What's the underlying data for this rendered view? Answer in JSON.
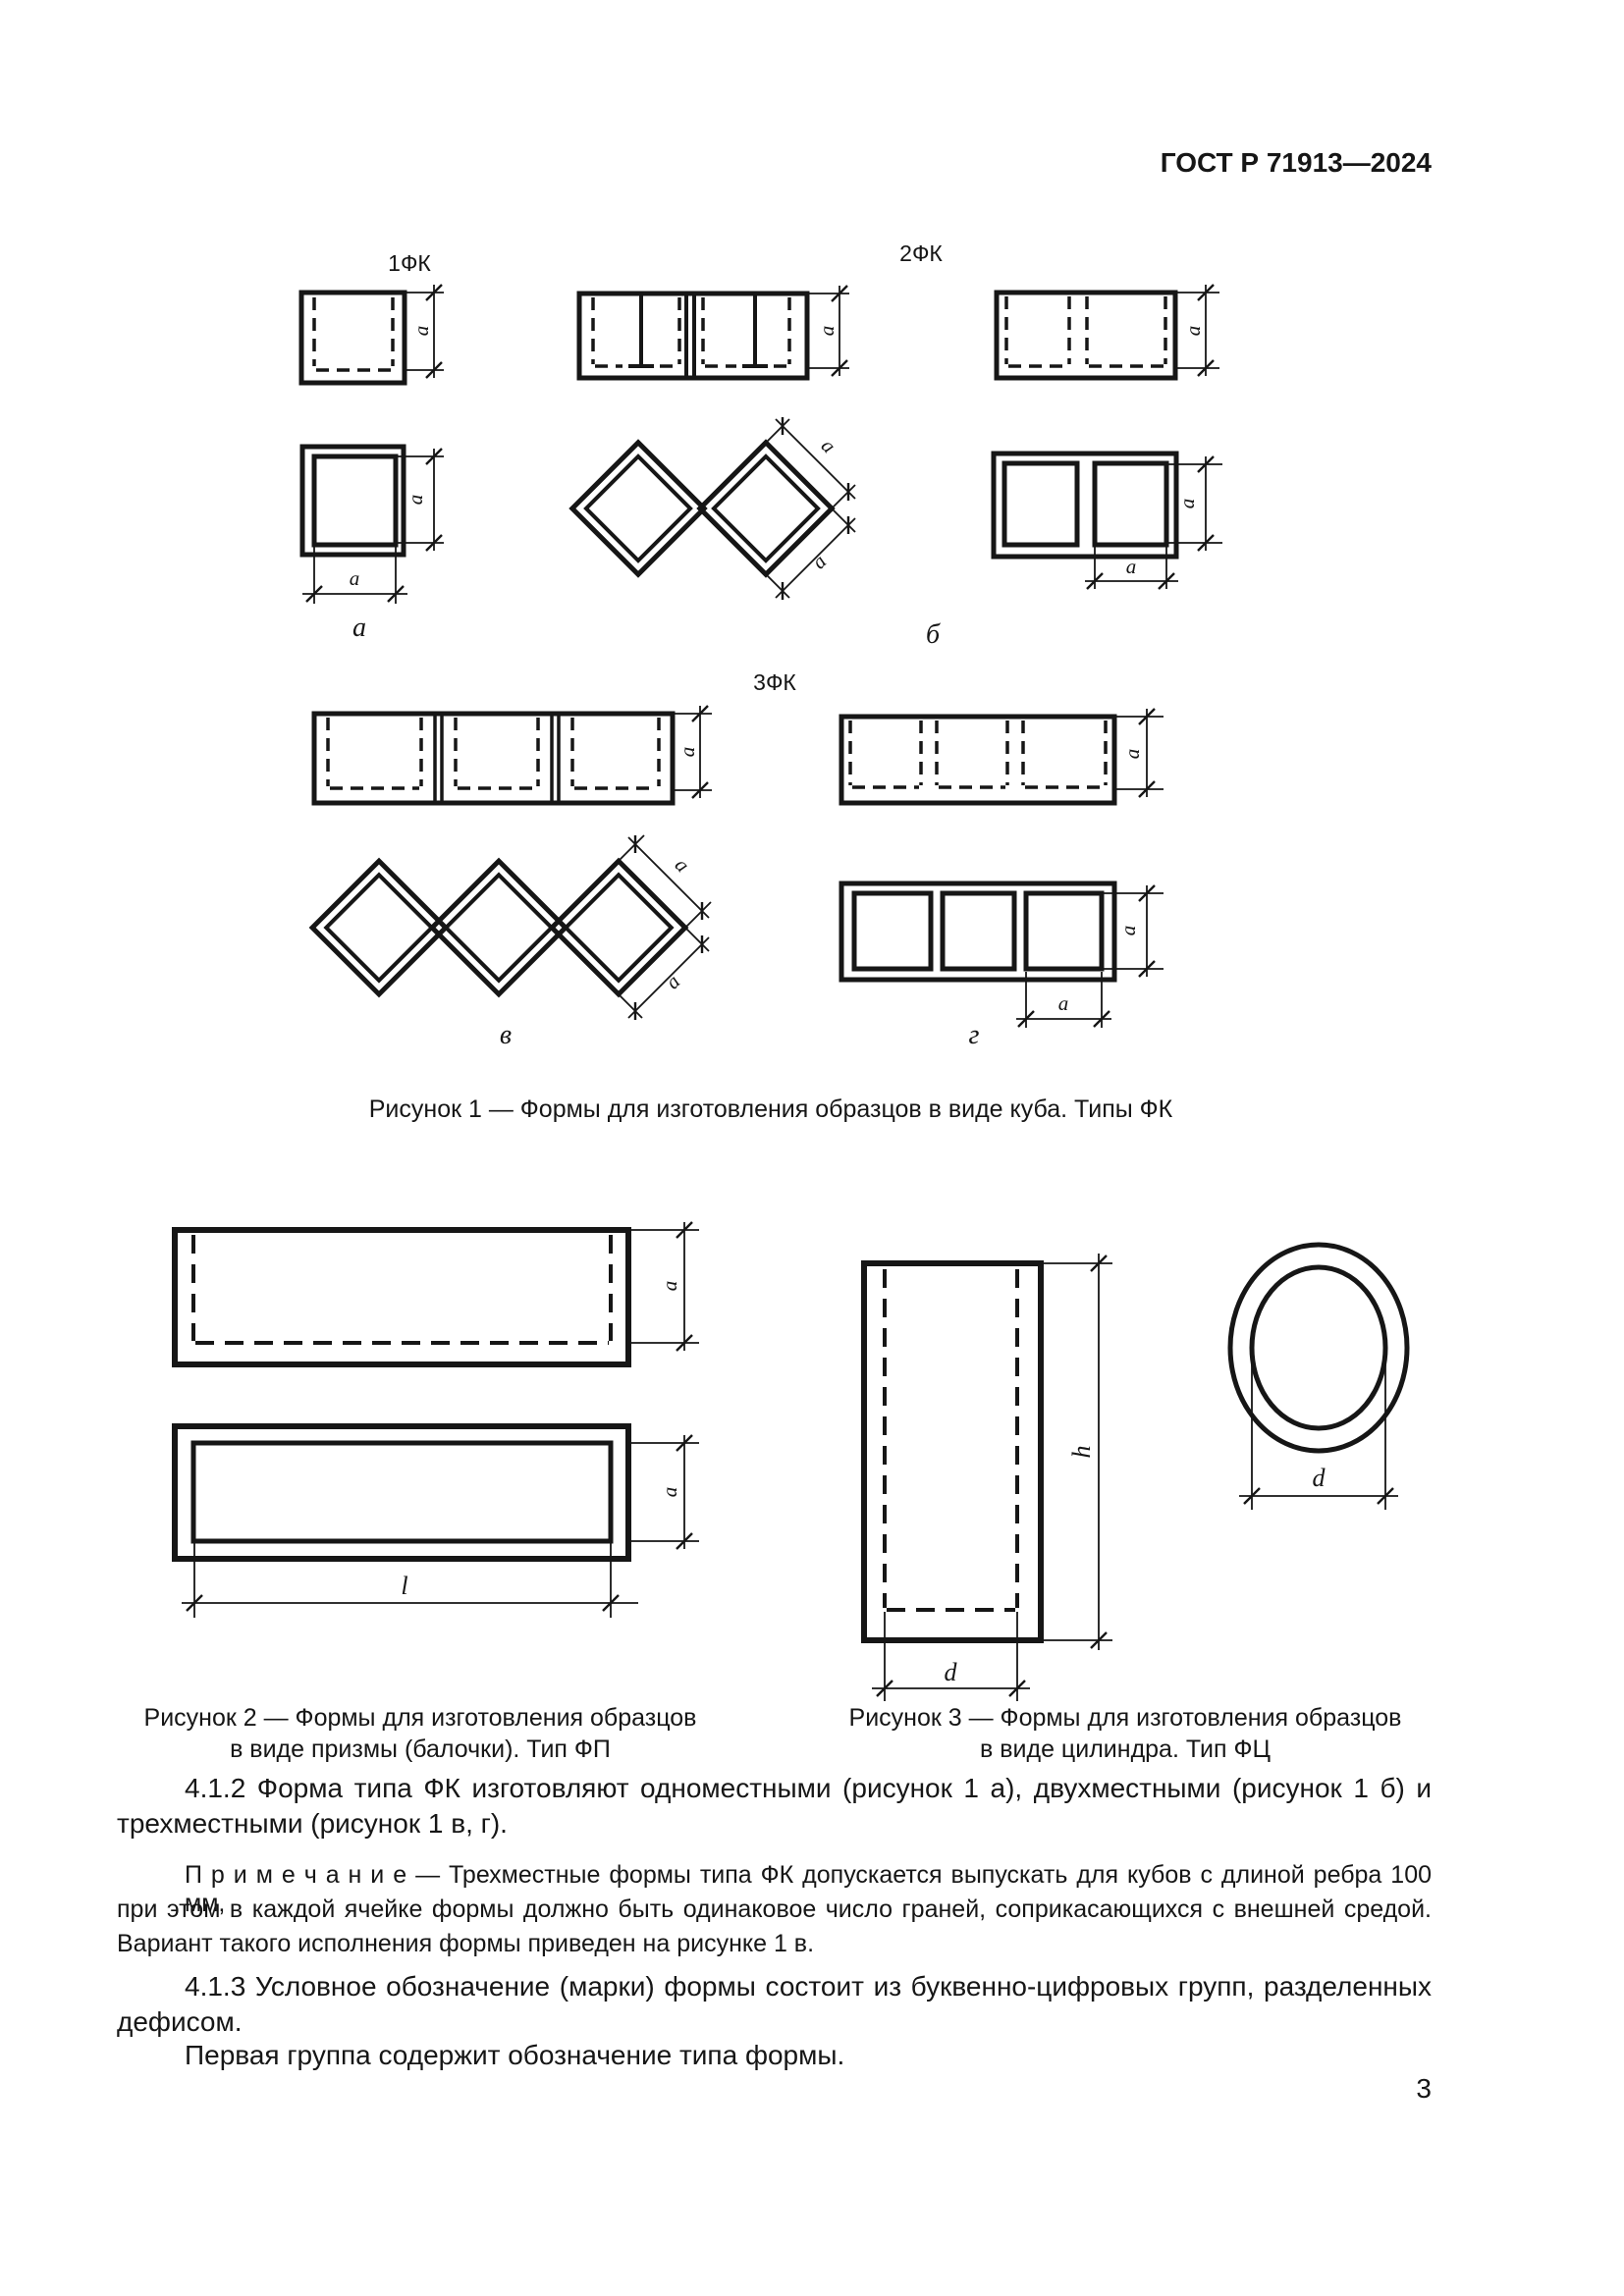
{
  "header": {
    "title": "ГОСТ Р 71913—2024"
  },
  "dims": {
    "edge": "a",
    "length": "l",
    "height": "h",
    "diameter": "d"
  },
  "figure1": {
    "group_labels": {
      "fk1": "1ФК",
      "fk2": "2ФК",
      "fk3": "3ФК"
    },
    "part_labels": {
      "a": "а",
      "b": "б",
      "v": "в",
      "g": "г"
    },
    "caption": "Рисунок 1 — Формы для изготовления образцов в виде куба. Типы ФК"
  },
  "figure2": {
    "caption_line1": "Рисунок 2 — Формы для изготовления образцов",
    "caption_line2": "в виде призмы (балочки). Тип ФП"
  },
  "figure3": {
    "caption_line1": "Рисунок 3 — Формы для изготовления образцов",
    "caption_line2": "в виде цилиндра. Тип ФЦ"
  },
  "body": {
    "p412_line1": "4.1.2 Форма типа ФК изготовляют одноместными (рисунок 1 а), двухместными (рисунок 1 б) и",
    "p412_line2": "трехместными (рисунок 1 в, г).",
    "note_line1": "П р и м е ч а н и е — Трехместные формы типа ФК допускается выпускать для кубов с длиной ребра 100 мм,",
    "note_line2": "при этом в каждой ячейке формы должно быть одинаковое число граней, соприкасающихся с внешней средой.",
    "note_line3": "Вариант такого исполнения формы приведен на рисунке 1 в.",
    "p413_line1": "4.1.3 Условное обозначение (марки) формы состоит из буквенно-цифровых групп, разделенных",
    "p413_line2": "дефисом.",
    "p413_line3": "Первая группа содержит обозначение типа формы."
  },
  "page_number": "3"
}
